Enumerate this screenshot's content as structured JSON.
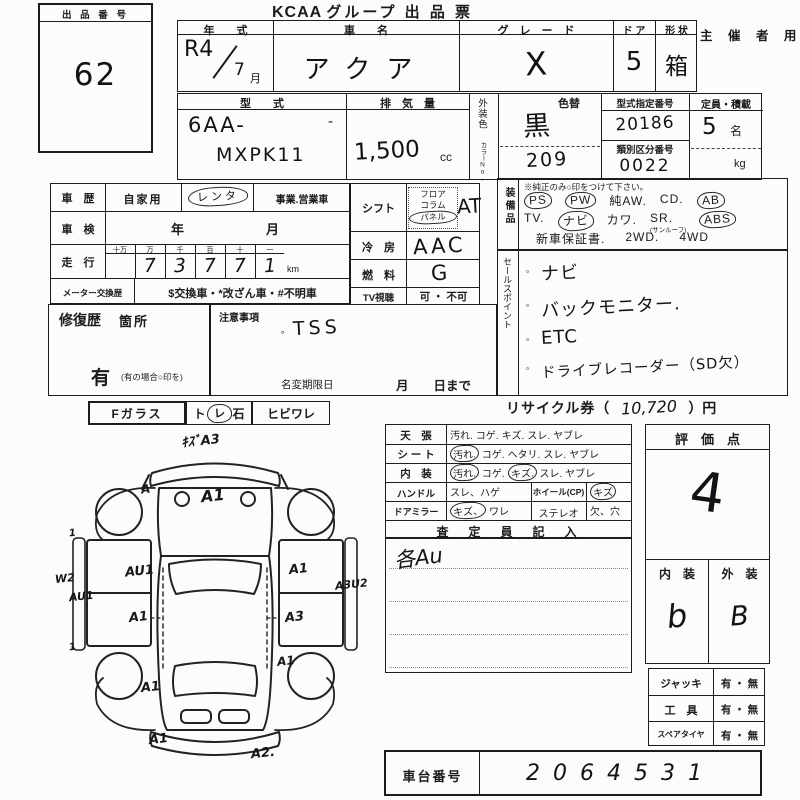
{
  "title": {
    "brand": "KCAA",
    "rest": "グループ 出 品 票",
    "use": "主 催 者 用"
  },
  "auction_no": {
    "label": "出 品 番 号",
    "value": "62"
  },
  "head": {
    "year_label": "年　　式",
    "year_a": "R4",
    "year_b": "7",
    "year_month": "月",
    "name_label": "車　　名",
    "name_value": "アクア",
    "grade_label": "グ　レ　ー　ド",
    "grade_value": "X",
    "door_label": "ド ア",
    "door_value": "5",
    "shape_label": "形 状",
    "shape_value": "箱"
  },
  "spec": {
    "model_label": "型　　式",
    "model_line1": "6AA-",
    "model_line2": "MXPK11",
    "model_tick": "‐",
    "disp_label": "排　気　量",
    "disp_value": "1,500",
    "disp_unit": "cc",
    "color_label": "外装色",
    "color_sub": "カラーNo.",
    "color_alt": "色替",
    "color_value": "黒",
    "color_code": "209",
    "typeno_label": "型式指定番号",
    "typeno_value": "20186",
    "classno_label": "類別区分番号",
    "classno_value": "0022",
    "cap_label": "定員・積載",
    "cap_value": "5",
    "cap_unit": "名",
    "cap_unit2": "kg"
  },
  "history": {
    "label": "車　歴",
    "opt_private": "自家用",
    "opt_rental": "レンタ",
    "opt_business": "事業.営業車",
    "insp_label": "車　検",
    "insp_value": "年　　　　月",
    "run_label": "走　行",
    "run_headers": [
      "十万",
      "万",
      "千",
      "百",
      "十",
      "一"
    ],
    "run_digits": [
      "",
      "7",
      "3",
      "7",
      "7",
      "1"
    ],
    "run_unit": "km",
    "meter_label": "メーター交換歴",
    "meter_value": "$交換車・*改ざん車・#不明車"
  },
  "drive": {
    "shift_label": "シフト",
    "shift_opts": [
      {
        "t": "フロア"
      },
      {
        "t": "コラム"
      },
      {
        "t": "パネル",
        "c": 1
      }
    ],
    "shift_value": "AT",
    "ac_label": "冷　房",
    "ac_value": "AAC",
    "fuel_label": "燃　料",
    "fuel_value": "G",
    "tv_label": "TV視聴",
    "tv_value": "可 ・ 不可"
  },
  "equip": {
    "label": "装備品",
    "note": "※純正のみ○印をつけて下さい。",
    "line1": [
      {
        "t": "PS",
        "c": 1
      },
      {
        "t": "PW",
        "c": 1
      },
      {
        "t": "純AW."
      },
      {
        "t": "CD."
      },
      {
        "t": "AB",
        "c": 1
      }
    ],
    "line2": [
      {
        "t": "TV."
      },
      {
        "t": "ナビ",
        "c": 1
      },
      {
        "t": "カワ."
      },
      {
        "t": "SR.",
        "sub": "(サンルーフ)"
      },
      {
        "t": "ABS",
        "c": 1
      }
    ],
    "line3": [
      {
        "t": "新車保証書."
      },
      {
        "t": "2WD."
      },
      {
        "t": "4WD"
      }
    ]
  },
  "sales": {
    "label": "セールスポイント",
    "items": [
      "ナビ",
      "バックモニター.",
      "ETC",
      "ドライブレコーダー（SD欠）"
    ]
  },
  "repair": {
    "label": "修復歴",
    "label2": "箇所",
    "yes": "有",
    "note": "(有の場合○印を)"
  },
  "caution": {
    "label": "注意事項",
    "bullet": "。",
    "value": "TSS",
    "rename_label": "名変期限日",
    "rename_value": "月　　日まで"
  },
  "glass": {
    "label": "Fガラス",
    "pre": "ト",
    "mark": "レ",
    "post": "石",
    "opt2": "ヒビワレ"
  },
  "recycle": {
    "label": "リサイクル券（",
    "value": "10,720",
    "suffix": "）円"
  },
  "cond": {
    "rows": [
      {
        "label": "天　張",
        "opts": [
          {
            "t": "汚れ."
          },
          {
            "t": "コゲ."
          },
          {
            "t": "キズ."
          },
          {
            "t": "スレ."
          },
          {
            "t": "ヤブレ"
          }
        ]
      },
      {
        "label": "シ ー ト",
        "opts": [
          {
            "t": "汚れ.",
            "c": 1
          },
          {
            "t": "コゲ."
          },
          {
            "t": "ヘタリ."
          },
          {
            "t": "スレ."
          },
          {
            "t": "ヤブレ"
          }
        ]
      },
      {
        "label": "内　装",
        "opts": [
          {
            "t": "汚れ.",
            "c": 1
          },
          {
            "t": "コゲ."
          },
          {
            "t": "キズ.",
            "c": 1
          },
          {
            "t": "スレ."
          },
          {
            "t": "ヤブレ"
          }
        ]
      }
    ],
    "handle_label": "ハンドル",
    "handle_opts": [
      {
        "t": "スレ、ハゲ"
      }
    ],
    "wheel_label": "ホイール(CP)",
    "wheel_value": [
      {
        "t": "キズ",
        "c": 1
      }
    ],
    "mirror_label": "ドアミラー",
    "mirror_opts": [
      {
        "t": "キズ、",
        "c": 1
      },
      {
        "t": "ワレ"
      }
    ],
    "stereo_label": "ステレオ",
    "stereo_value": [
      {
        "t": "欠、穴"
      }
    ],
    "assessor_label": "査　定　員　記　入",
    "assessor_value": "各Au"
  },
  "score": {
    "label": "評　価　点",
    "value": "4",
    "in_label": "内　装",
    "out_label": "外　装",
    "in_value": "b",
    "out_value": "B"
  },
  "acc": {
    "rows": [
      {
        "label": "ジャッキ",
        "value": "有 ・ 無"
      },
      {
        "label": "工　具",
        "value": "有 ・ 無"
      },
      {
        "label": "スペアタイヤ",
        "value": "有 ・ 無"
      }
    ]
  },
  "chassis": {
    "label": "車台番号",
    "value": "2064531"
  },
  "diagram": {
    "annotations": [
      {
        "t": "ｷｽﾞA3",
        "x": 126,
        "y": 2,
        "s": 13
      },
      {
        "t": "A1",
        "x": 146,
        "y": 58,
        "s": 16
      },
      {
        "t": "A",
        "x": 86,
        "y": 54,
        "s": 12
      },
      {
        "t": "AU1",
        "x": 70,
        "y": 136,
        "s": 13
      },
      {
        "t": "A1",
        "x": 74,
        "y": 182,
        "s": 13
      },
      {
        "t": "AU1",
        "x": 14,
        "y": 162,
        "s": 11
      },
      {
        "t": "W2",
        "x": 0,
        "y": 144,
        "s": 11
      },
      {
        "t": "1",
        "x": 14,
        "y": 100,
        "s": 10
      },
      {
        "t": "1",
        "x": 14,
        "y": 214,
        "s": 10
      },
      {
        "t": "A1",
        "x": 86,
        "y": 252,
        "s": 13
      },
      {
        "t": "A1",
        "x": 234,
        "y": 134,
        "s": 13
      },
      {
        "t": "A3",
        "x": 230,
        "y": 182,
        "s": 13
      },
      {
        "t": "A3U2",
        "x": 280,
        "y": 150,
        "s": 11
      },
      {
        "t": "A1",
        "x": 222,
        "y": 226,
        "s": 12
      },
      {
        "t": "A1",
        "x": 94,
        "y": 304,
        "s": 13
      },
      {
        "t": "A2.",
        "x": 196,
        "y": 318,
        "s": 13
      }
    ]
  }
}
